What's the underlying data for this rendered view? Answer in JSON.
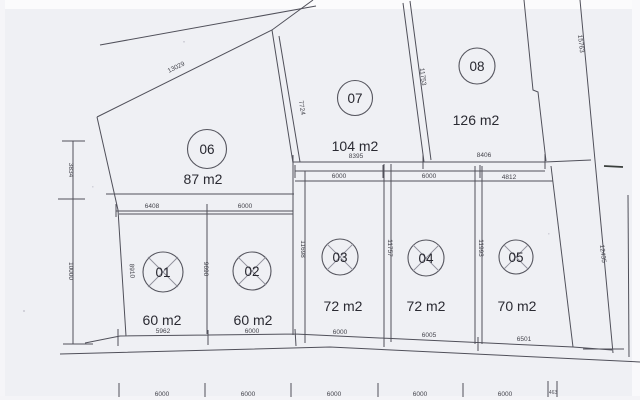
{
  "plots": [
    {
      "num": "01",
      "area": "60 m2"
    },
    {
      "num": "02",
      "area": "60 m2"
    },
    {
      "num": "03",
      "area": "72 m2"
    },
    {
      "num": "04",
      "area": "72 m2"
    },
    {
      "num": "05",
      "area": "70 m2"
    },
    {
      "num": "06",
      "area": "87 m2"
    },
    {
      "num": "07",
      "area": "104 m2"
    },
    {
      "num": "08",
      "area": "126 m2"
    }
  ],
  "dims": {
    "north_boundary": "13029",
    "plot06_east": "7724",
    "plot07_08": "11753",
    "east_upper": "15763",
    "east_lower": "12435",
    "west_upper": "3834",
    "west_lower": "10000",
    "plot01_west": "8910",
    "plot01_02": "9690",
    "plot02_03": "11698",
    "plot03_04": "11757",
    "plot04_05": "11993",
    "plot07_width": "8395",
    "plot08_width": "8406",
    "row2_top": [
      "6000",
      "6000",
      "4812"
    ],
    "row1_top": [
      "6408",
      "6000"
    ],
    "row1_bottom": [
      "5962",
      "6000"
    ],
    "row2_bottom": [
      "6000",
      "6005",
      "6501"
    ],
    "street_scale": [
      "6000",
      "6000",
      "6000",
      "6000",
      "6000",
      "463"
    ]
  }
}
